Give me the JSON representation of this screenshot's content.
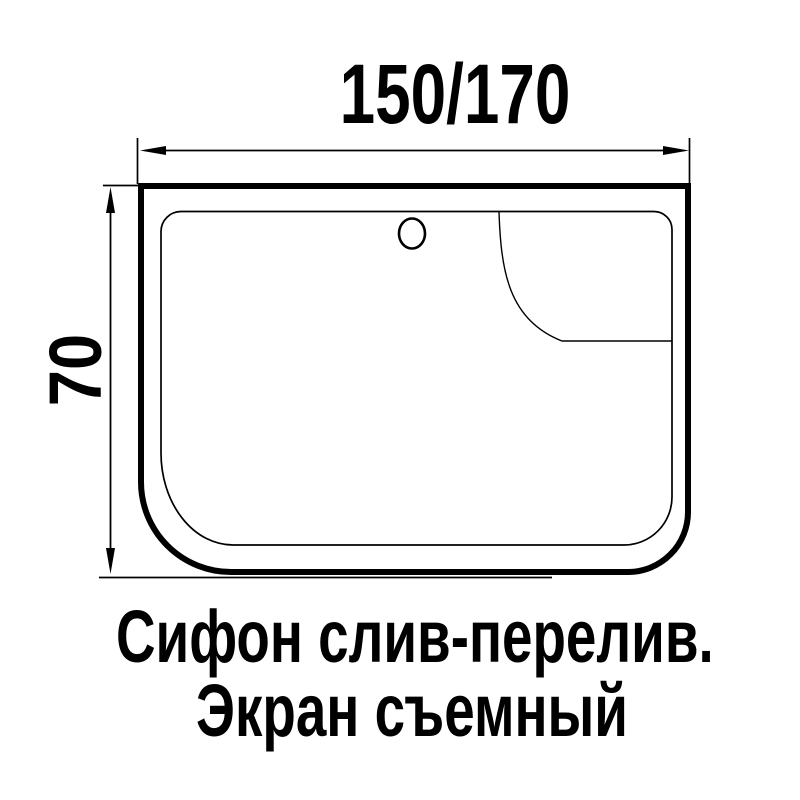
{
  "colors": {
    "background": "#ffffff",
    "ink": "#000000"
  },
  "drawing": {
    "width_dimension_label": "150/170",
    "height_dimension_label": "70",
    "caption_line1": "Сифон слив-перелив.",
    "caption_line2": "Экран съемный",
    "icons": {
      "overflow_hole_icon": "circle-outline"
    }
  }
}
